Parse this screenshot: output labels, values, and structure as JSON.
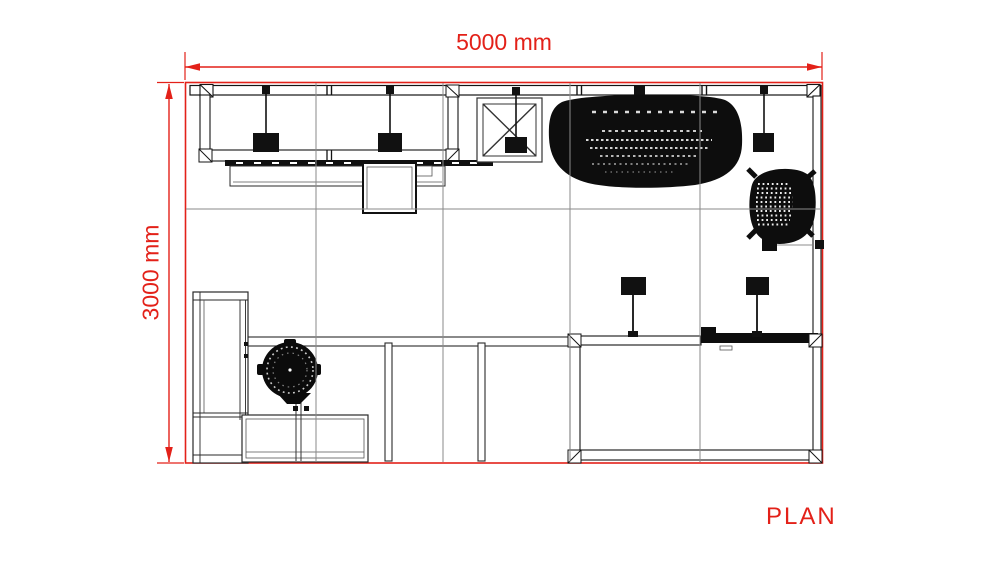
{
  "page": {
    "title_label": "PLAN"
  },
  "dimensions": {
    "width_label": "5000 mm",
    "height_label": "3000 mm"
  },
  "colors": {
    "dimension_red": "#e32119",
    "drawing_black": "#141414",
    "thin_line_gray": "#555555",
    "grid_gray": "#8a8a8a",
    "background": "#ffffff"
  },
  "elements": {
    "items": [
      "back-wall-display",
      "pendant-light",
      "display-counter",
      "square-table",
      "cross-braced-table",
      "organic-canopy",
      "office-chair",
      "storage-room",
      "counter-wall",
      "spot-light",
      "wardrobe-cabinet",
      "reception-desk",
      "round-chair",
      "partition-fin",
      "floor-grid"
    ]
  }
}
